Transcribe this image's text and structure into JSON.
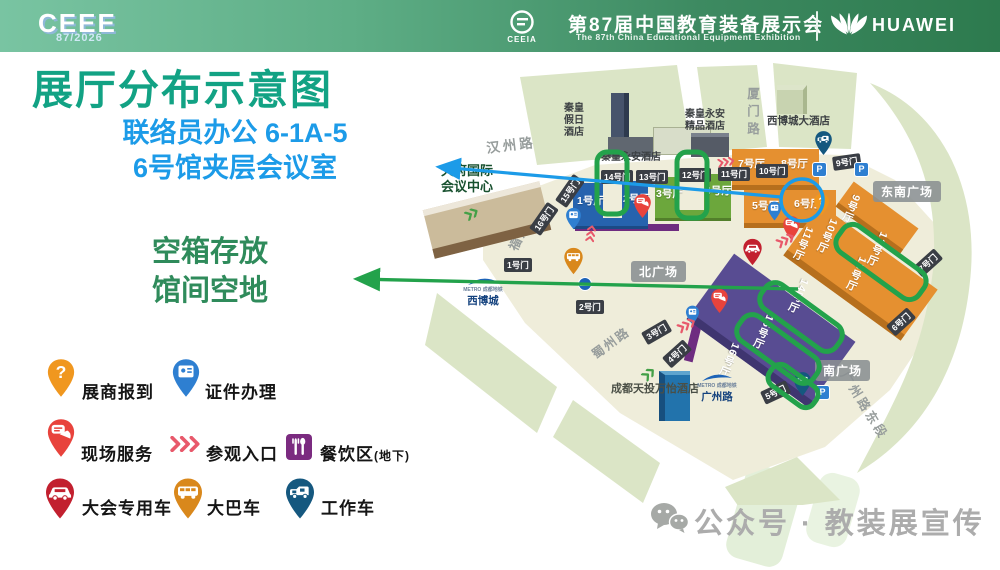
{
  "header": {
    "logo_main": "CEEE",
    "logo_sub": "87/2026",
    "ceeia": "CEEIA",
    "title_cn": "第87届中国教育装备展示会",
    "title_en": "The 87th China Educational Equipment Exhibition",
    "huawei": "HUAWEI"
  },
  "title": "展厅分布示意图",
  "callout_liaison": {
    "line1": "联络员办公 6-1A-5",
    "line2": "6号馆夹层会议室"
  },
  "callout_storage": {
    "line1": "空箱存放",
    "line2": "馆间空地"
  },
  "legend": {
    "register": "展商报到",
    "credential": "证件办理",
    "service": "现场服务",
    "entrance": "参观入口",
    "dining": "餐饮区",
    "dining_suffix": "(地下)",
    "conference_car": "大会专用车",
    "bus": "大巴车",
    "work_car": "工作车"
  },
  "map": {
    "roads": {
      "hanzhou": "汉州路",
      "fuzhou": "福州路",
      "xiamen": "厦门路",
      "shuzhou": "蜀州路",
      "guangzhou_east": "广州路东段"
    },
    "metro": {
      "brand": "METRO 成都地铁",
      "station_xibocheng": "西博城",
      "station_guangzhoulu": "广州路"
    },
    "buildings": {
      "tianfu": "天府国际会议中心",
      "qh_holiday": "秦皇假日酒店",
      "qh_yongan": "秦皇永安酒店",
      "qh_boutique": "秦皇永安精品酒店",
      "xbc_hotel": "西博城大酒店",
      "marriott": "成都天投万怡酒店"
    },
    "halls": {
      "h1": "1号厅",
      "h2": "2号厅",
      "h3": "3号厅",
      "h4": "4号厅",
      "h5": "5号厅",
      "h6": "6号厅",
      "h7": "7号厅",
      "h8": "8号厅",
      "h9": "9号厅",
      "h10": "10号厅",
      "h11": "11号厅",
      "h12": "12号厅",
      "h13": "13号厅",
      "h14": "14号厅",
      "h15": "15号厅",
      "h16": "16号厅"
    },
    "gates": {
      "g1": "1号门",
      "g2": "2号门",
      "g3": "3号门",
      "g4": "4号门",
      "g5": "5号门",
      "g6": "6号门",
      "g7": "7号门",
      "g9": "9号门",
      "g10": "10号门",
      "g11": "11号门",
      "g12": "12号门",
      "g13": "13号门",
      "g14": "14号门",
      "g15": "15号门",
      "g16": "16号门"
    },
    "plazas": {
      "north": "北广场",
      "southeast": "东南广场",
      "south": "南广场"
    },
    "parking_label": "P"
  },
  "footer": {
    "text": "公众号 · 教装展宣传"
  },
  "colors": {
    "title_green": "#12a284",
    "callout_blue": "#1c9be8",
    "callout_dark_green": "#2f8b5b",
    "highlight_green": "#23a24b",
    "hall_blue": "#2663ae",
    "hall_green": "#6ca73c",
    "hall_orange": "#e59030",
    "hall_purple": "#584c92",
    "pin_register": "#f0971f",
    "pin_credential": "#2e7fd1",
    "pin_service": "#e8433c",
    "pin_conference_car": "#c2202f",
    "pin_bus": "#d9881c",
    "pin_work_car": "#15587f",
    "dining_purple": "#7b2b80"
  }
}
